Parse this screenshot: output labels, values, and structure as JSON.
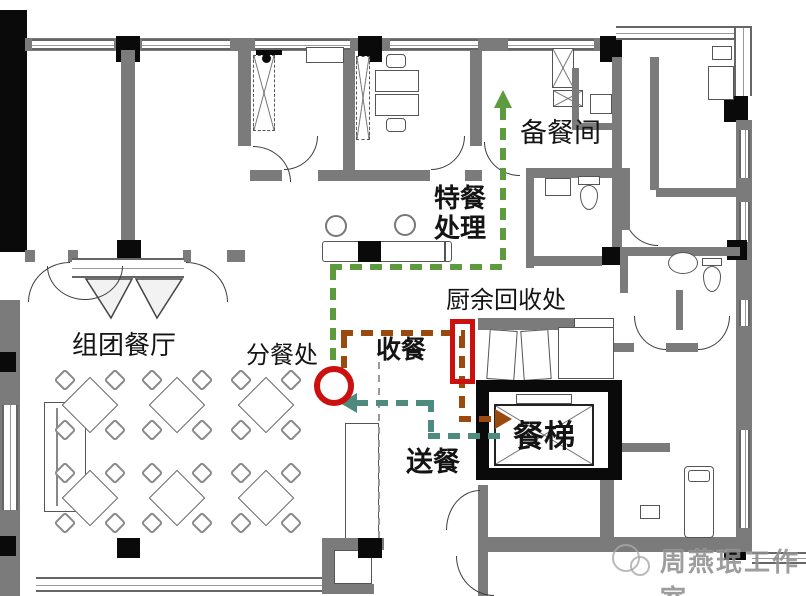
{
  "colors": {
    "special-route": "#5e9a3e",
    "collect-route": "#9a4a0f",
    "deliver-route": "#4e8b7e",
    "marker-red": "#cb100e"
  },
  "labels": {
    "prep_room": "备餐间",
    "special_meal_l1": "特餐",
    "special_meal_l2": "处理",
    "waste_recycle": "厨余回收处",
    "collect_meal": "收餐",
    "serving_point": "分餐处",
    "group_dining": "组团餐厅",
    "deliver_meal": "送餐",
    "food_elevator": "餐梯"
  },
  "watermark": {
    "studio": "周燕珉工作室"
  },
  "flows": [
    {
      "name": "special-meal-route",
      "label": "特餐处理",
      "color": "#5e9a3e"
    },
    {
      "name": "meal-collect-route",
      "label": "收餐",
      "color": "#9a4a0f"
    },
    {
      "name": "meal-deliver-route",
      "label": "送餐",
      "color": "#4e8b7e"
    }
  ],
  "markers": [
    {
      "name": "serving-point-circle",
      "shape": "circle",
      "color": "#cb100e",
      "label": "分餐处"
    },
    {
      "name": "waste-recycle-window",
      "shape": "rectangle",
      "color": "#cb100e",
      "label": "厨余回收处"
    }
  ]
}
